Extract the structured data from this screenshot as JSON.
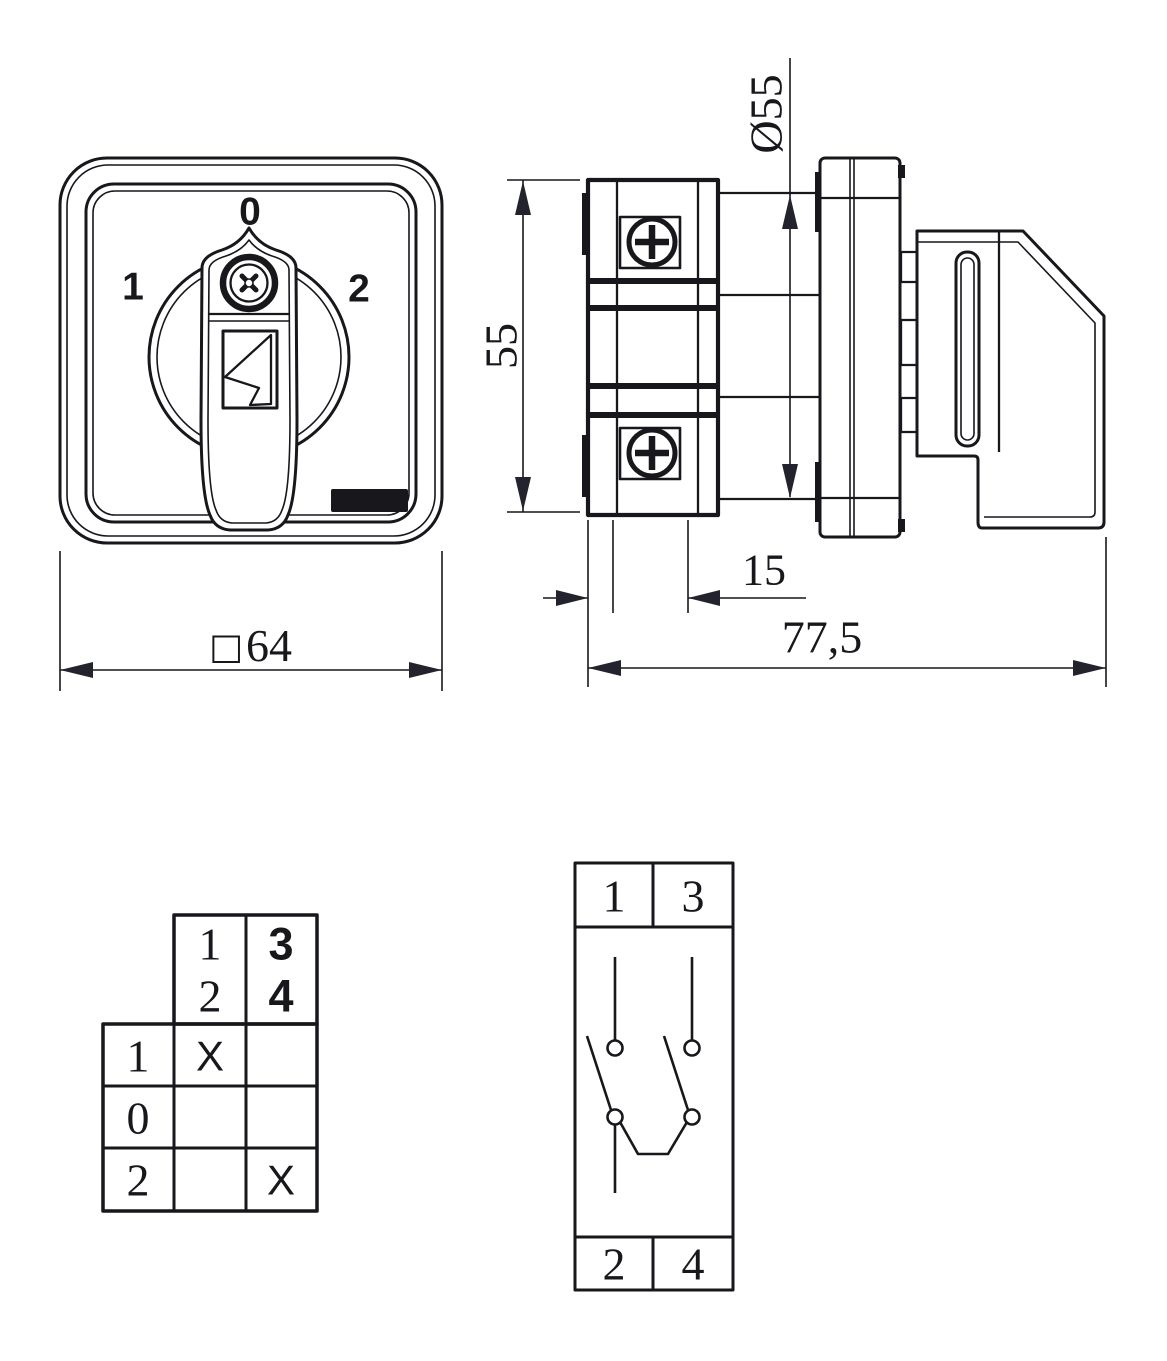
{
  "colors": {
    "ink": "#17171c",
    "background": "#ffffff"
  },
  "front_view": {
    "position_left": "1",
    "position_top": "0",
    "position_right": "2",
    "width_symbol": "□",
    "width_value": "64"
  },
  "side_view": {
    "height_value": "55",
    "diameter_label": "Ø55",
    "module_depth_value": "15",
    "total_depth_value": "77,5"
  },
  "contact_table": {
    "header_col_12": [
      "1",
      "2"
    ],
    "header_col_34": [
      "3",
      "4"
    ],
    "rows": [
      {
        "position": "1",
        "contact_12": "X",
        "contact_34": ""
      },
      {
        "position": "0",
        "contact_12": "",
        "contact_34": ""
      },
      {
        "position": "2",
        "contact_12": "",
        "contact_34": "X"
      }
    ]
  },
  "circuit_diagram": {
    "terminals_top": [
      "1",
      "3"
    ],
    "terminals_bottom": [
      "2",
      "4"
    ]
  }
}
